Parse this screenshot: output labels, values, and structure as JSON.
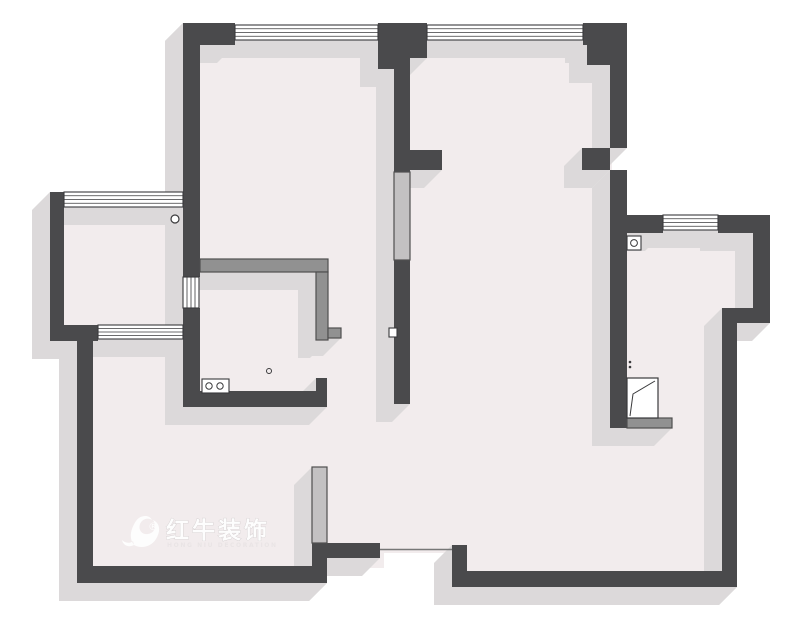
{
  "meta": {
    "type": "apartment-floor-plan",
    "canvas": {
      "width": 800,
      "height": 640
    }
  },
  "palette": {
    "background": "#ffffff",
    "floor": "#f2eced",
    "wall": "#4a4a4c",
    "shadow": "#dcd9da",
    "partition_mid_fill": "#919191",
    "partition_light_fill": "#c3c1c2",
    "partition_stroke": "#4f4f4f",
    "window_fill": "#ffffff",
    "line": "#3a3a3c",
    "threshold_line": "#777777",
    "watermark_fill": "#ffffff",
    "watermark_stroke": "#cbc6c7",
    "watermark_sub": "#e9e4e5"
  },
  "shadow_offset": 18,
  "floors": [
    [
      64,
      205,
      119,
      122
    ],
    [
      198,
      40,
      198,
      353
    ],
    [
      408,
      40,
      204,
      513
    ],
    [
      467,
      543,
      145,
      30
    ],
    [
      610,
      231,
      145,
      81
    ],
    [
      610,
      306,
      114,
      268
    ],
    [
      91,
      339,
      293,
      229
    ],
    [
      326,
      258,
      86,
      295
    ]
  ],
  "walls": [
    [
      183,
      23,
      52,
      22
    ],
    [
      378,
      23,
      49,
      22
    ],
    [
      378,
      43,
      20,
      26
    ],
    [
      410,
      43,
      17,
      15
    ],
    [
      583,
      23,
      44,
      22
    ],
    [
      587,
      45,
      26,
      20
    ],
    [
      183,
      23,
      17,
      254
    ],
    [
      183,
      308,
      17,
      99
    ],
    [
      394,
      26,
      16,
      146
    ],
    [
      394,
      260,
      16,
      144
    ],
    [
      410,
      150,
      32,
      20
    ],
    [
      610,
      43,
      17,
      105
    ],
    [
      582,
      148,
      28,
      22
    ],
    [
      610,
      170,
      17,
      63
    ],
    [
      610,
      233,
      17,
      195
    ],
    [
      627,
      215,
      36,
      18
    ],
    [
      718,
      215,
      52,
      18
    ],
    [
      753,
      233,
      17,
      75
    ],
    [
      722,
      308,
      48,
      15
    ],
    [
      722,
      323,
      15,
      264
    ],
    [
      452,
      571,
      285,
      16
    ],
    [
      452,
      545,
      15,
      42
    ],
    [
      77,
      566,
      250,
      17
    ],
    [
      77,
      341,
      16,
      242
    ],
    [
      50,
      325,
      48,
      16
    ],
    [
      50,
      192,
      14,
      133
    ],
    [
      183,
      391,
      144,
      16
    ],
    [
      316,
      378,
      11,
      13
    ],
    [
      312,
      543,
      15,
      40
    ],
    [
      312,
      543,
      68,
      15
    ]
  ],
  "windows": [
    {
      "x": 235,
      "y": 25,
      "w": 143,
      "h": 15,
      "orient": "h",
      "name": "window-bedroom-top"
    },
    {
      "x": 427,
      "y": 25,
      "w": 156,
      "h": 15,
      "orient": "h",
      "name": "window-living-top"
    },
    {
      "x": 64,
      "y": 192,
      "w": 119,
      "h": 15,
      "orient": "h",
      "name": "window-balcony-top"
    },
    {
      "x": 98,
      "y": 325,
      "w": 85,
      "h": 14,
      "orient": "h",
      "name": "window-balcony-bottom"
    },
    {
      "x": 663,
      "y": 215,
      "w": 55,
      "h": 15,
      "orient": "h",
      "name": "window-bathroom-top"
    },
    {
      "x": 183,
      "y": 277,
      "w": 16,
      "h": 31,
      "orient": "v",
      "name": "sliding-door-kitchen"
    }
  ],
  "partitions": [
    {
      "x": 200,
      "y": 259,
      "w": 128,
      "h": 13,
      "tone": "mid",
      "name": "counter-top"
    },
    {
      "x": 316,
      "y": 272,
      "w": 12,
      "h": 68,
      "tone": "mid",
      "name": "counter-right"
    },
    {
      "x": 328,
      "y": 328,
      "w": 13,
      "h": 10,
      "tone": "mid",
      "name": "counter-end-tab"
    },
    {
      "x": 394,
      "y": 172,
      "w": 16,
      "h": 88,
      "tone": "light",
      "name": "light-wall-segment-center"
    },
    {
      "x": 312,
      "y": 467,
      "w": 15,
      "h": 76,
      "tone": "light",
      "name": "light-wall-segment-bottom"
    },
    {
      "x": 627,
      "y": 418,
      "w": 45,
      "h": 10,
      "tone": "mid",
      "name": "appliance-sill"
    }
  ],
  "fixtures": {
    "stove": {
      "x": 202,
      "y": 379,
      "w": 27,
      "h": 14,
      "burners": [
        [
          209,
          386
        ],
        [
          220,
          386
        ]
      ],
      "r": 3.2
    },
    "gas_meter": {
      "x": 627,
      "y": 236,
      "w": 14,
      "h": 14,
      "cx": 634,
      "cy": 243,
      "r": 3.4
    },
    "water_heater": {
      "x": 627,
      "y": 378,
      "w": 31,
      "h": 40,
      "fold": [
        [
          630,
          416
        ],
        [
          633,
          394
        ],
        [
          655,
          381
        ]
      ]
    },
    "hinge_dots": [
      [
        630,
        362
      ],
      [
        630,
        367
      ]
    ],
    "pipe_circle_balcony": {
      "cx": 175,
      "cy": 219,
      "r": 4
    },
    "pipe_circle_kitchen": {
      "cx": 269,
      "cy": 371,
      "r": 2.5
    },
    "wall_socket": {
      "x": 389,
      "y": 328,
      "w": 8,
      "h": 9
    },
    "entry_threshold": {
      "x1": 380,
      "y1": 549.5,
      "x2": 452,
      "y2": 549.5
    }
  },
  "watermark": {
    "title": "红牛装饰",
    "subtitle": "HONG NIU DECORATION",
    "registered": "®"
  }
}
